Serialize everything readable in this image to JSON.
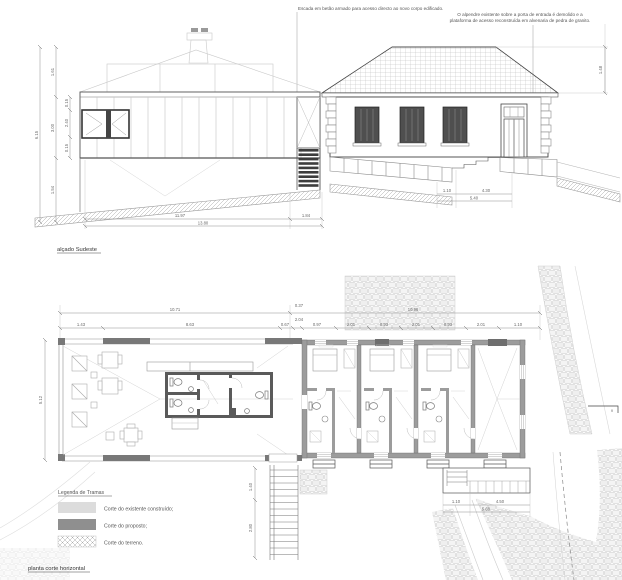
{
  "titles": {
    "elevation": "alçado Sudeste",
    "plan": "planta corte horizontal"
  },
  "notes": {
    "stair": "Escada em betão armado para acesso directo ao novo corpo edificado.",
    "porch_line1": "O alpendre existente sobre a porta de entrada é demolido e a",
    "porch_line2": "plataforma de acesso reconstruída em alvenaria de pedra de granito."
  },
  "legend": {
    "title": "Legenda de Tramas",
    "items": [
      {
        "swatch": "existing-light-gray",
        "label": "Corte do existente construído;"
      },
      {
        "swatch": "proposed-dark-gray",
        "label": "Corte do proposto;"
      },
      {
        "swatch": "terrain-crosshatch",
        "label": "Corte do terreno."
      }
    ]
  },
  "colors": {
    "existing_fill": "#dcdcdc",
    "proposed_fill": "#8f8f8f",
    "wall_existing": "#9c9c9c",
    "wall_proposed": "#5a5a5a",
    "shutter": "#4f4f4f",
    "line_dark": "#444444",
    "line_light": "#c9c9c9"
  },
  "dims": {
    "elevation": {
      "left_total": "6.15",
      "left_segs": [
        "1.61",
        "3.00",
        "1.54"
      ],
      "window_segs": [
        "0.15",
        "2.40",
        "0.15"
      ],
      "bottom_segs": [
        "11.97",
        "1.84"
      ],
      "bottom_total": "13.80",
      "roof_height": "1.48",
      "steps_segs": [
        "1.10",
        "4.30"
      ],
      "steps_total": "5.40"
    },
    "plan": {
      "top_left_total": "10.71",
      "top_right_total": "10.96",
      "junction_stack": [
        "0.37",
        "2.04"
      ],
      "segs_left": [
        "1.43",
        "8.63",
        "0.67"
      ],
      "segs_right": [
        "0.97",
        "2.01",
        "0.93",
        "2.01",
        "0.93",
        "2.01",
        "1.10"
      ],
      "left_height": "5.12",
      "stair_segs": [
        "1.40",
        "2.80"
      ],
      "steps_segs": [
        "1.10",
        "4.50"
      ],
      "steps_total": "5.60",
      "north_marker": "v"
    }
  }
}
